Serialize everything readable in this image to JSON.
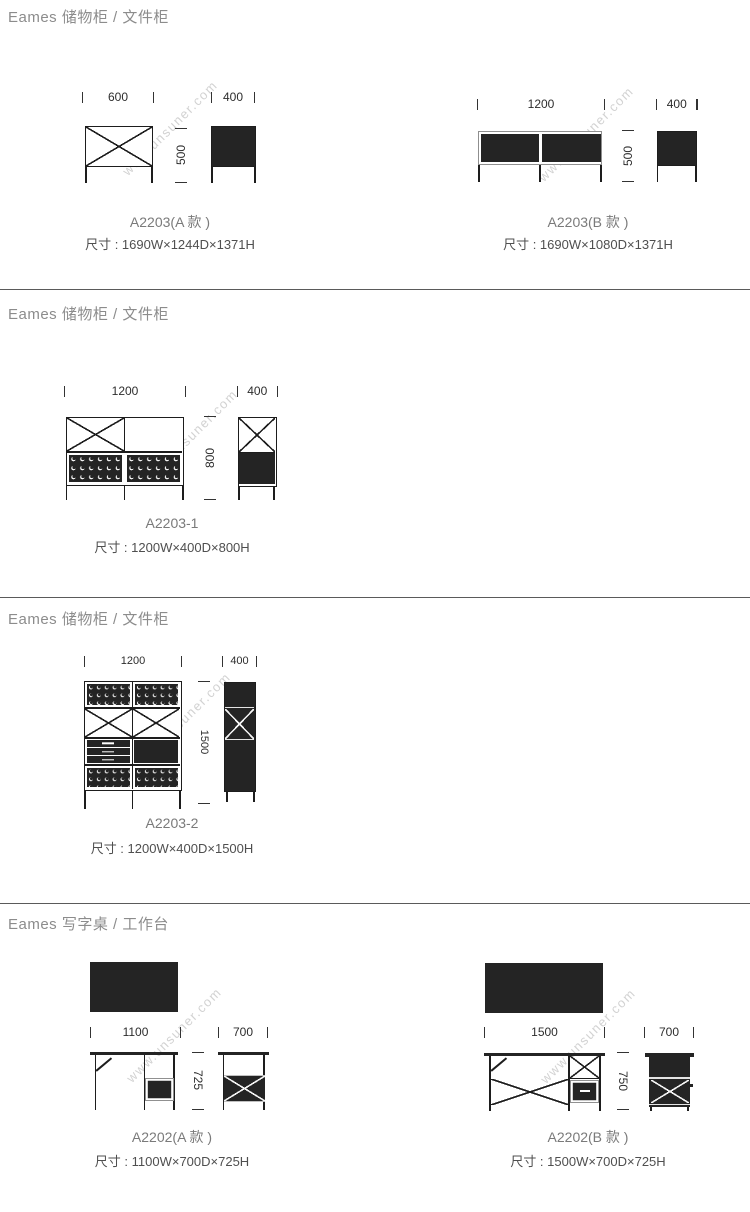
{
  "watermark": "www.unsuner.com",
  "colors": {
    "dark_fill": "#242424",
    "line": "#1d1d1d",
    "section_title": "#8c8c8c",
    "model_label": "#7a7a7a",
    "spec_text": "#4f4f4f",
    "dim_text": "#2d2d2d",
    "watermark": "#d2d2d2",
    "separator": "#5a5a5a"
  },
  "sections": [
    {
      "title": "Eames 储物柜 / 文件柜",
      "products": [
        {
          "model": "A2203(A 款 )",
          "spec": "尺寸 : 1690W×1244D×1371H",
          "dims": {
            "front_w": "600",
            "side_w": "400",
            "h": "500"
          }
        },
        {
          "model": "A2203(B 款 )",
          "spec": "尺寸 : 1690W×1080D×1371H",
          "dims": {
            "front_w": "1200",
            "side_w": "400",
            "h": "500"
          }
        }
      ]
    },
    {
      "title": "Eames 储物柜 / 文件柜",
      "products": [
        {
          "model": "A2203-1",
          "spec": "尺寸 : 1200W×400D×800H",
          "dims": {
            "front_w": "1200",
            "side_w": "400",
            "h": "800"
          }
        }
      ]
    },
    {
      "title": "Eames 储物柜 / 文件柜",
      "products": [
        {
          "model": "A2203-2",
          "spec": "尺寸 : 1200W×400D×1500H",
          "dims": {
            "front_w": "1200",
            "side_w": "400",
            "h": "1500"
          }
        }
      ]
    },
    {
      "title": "Eames 写字桌 / 工作台",
      "products": [
        {
          "model": "A2202(A 款 )",
          "spec": "尺寸 : 1100W×700D×725H",
          "dims": {
            "front_w": "1100",
            "side_w": "700",
            "h": "725"
          }
        },
        {
          "model": "A2202(B 款 )",
          "spec": "尺寸 : 1500W×700D×725H",
          "dims": {
            "front_w": "1500",
            "side_w": "700",
            "h": "750"
          }
        }
      ]
    }
  ]
}
